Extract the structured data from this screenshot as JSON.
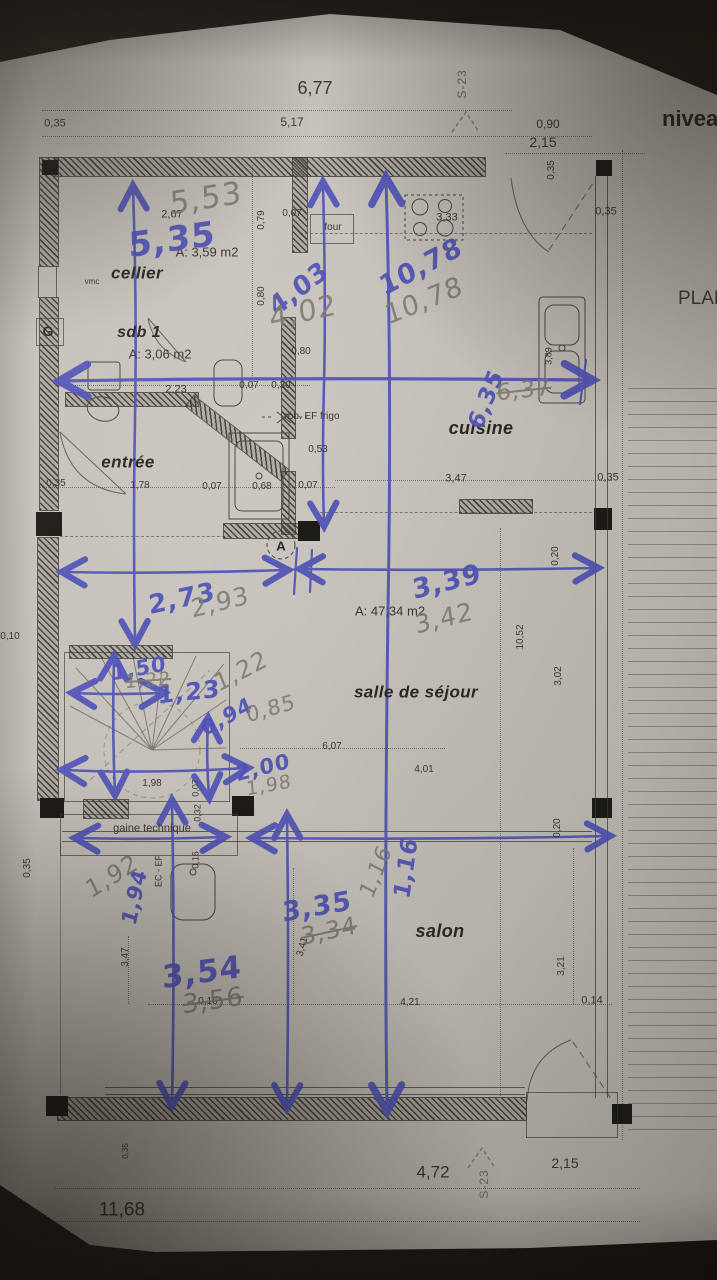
{
  "titles": {
    "level": "niveau",
    "plan": "PLAN"
  },
  "colors": {
    "ink_blue": "#5154b8",
    "pencil_gray": "#807c73",
    "print_dark": "#3b3934",
    "paper": "#c4c0b9"
  },
  "rooms": [
    {
      "t": "cellier",
      "x": 137,
      "y": 273,
      "s": 17
    },
    {
      "t": "sdb 1",
      "x": 139,
      "y": 333,
      "s": 16
    },
    {
      "t": "entrée",
      "x": 128,
      "y": 462,
      "s": 17
    },
    {
      "t": "cuisine",
      "x": 481,
      "y": 428,
      "s": 18
    },
    {
      "t": "salle de séjour",
      "x": 416,
      "y": 692,
      "s": 17
    },
    {
      "t": "salon",
      "x": 440,
      "y": 931,
      "s": 18
    }
  ],
  "area_labels": [
    {
      "t": "A: 3,59 m2",
      "x": 207,
      "y": 252,
      "s": 13
    },
    {
      "t": "A: 3,06 m2",
      "x": 160,
      "y": 354,
      "s": 13
    },
    {
      "t": "A: 47,34 m2",
      "x": 390,
      "y": 611,
      "s": 13
    }
  ],
  "small_labels": [
    {
      "t": "gaine technique",
      "x": 152,
      "y": 829,
      "s": 11
    },
    {
      "t": "four",
      "x": 333,
      "y": 228,
      "s": 10
    },
    {
      "t": "rob. EF frigo",
      "x": 312,
      "y": 417,
      "s": 10
    },
    {
      "t": "EC - EF",
      "x": 159,
      "y": 871,
      "s": 9,
      "r": -90
    },
    {
      "t": "vmc",
      "x": 92,
      "y": 282,
      "s": 8
    }
  ],
  "marker_labels": [
    {
      "t": "G",
      "x": 48,
      "y": 331,
      "s": 14
    },
    {
      "t": "A",
      "x": 281,
      "y": 546,
      "s": 13
    }
  ],
  "section_markers": [
    {
      "t": "S-23",
      "x": 462,
      "y": 84,
      "s": 12,
      "r": -90
    },
    {
      "t": "S-23",
      "x": 484,
      "y": 1184,
      "s": 12,
      "r": -90
    }
  ],
  "printed_dimensions": [
    {
      "t": "6,77",
      "x": 315,
      "y": 88,
      "s": 18
    },
    {
      "t": "0,35",
      "x": 55,
      "y": 124,
      "s": 11
    },
    {
      "t": "5,17",
      "x": 292,
      "y": 122,
      "s": 12
    },
    {
      "t": "0,90",
      "x": 548,
      "y": 124,
      "s": 12
    },
    {
      "t": "2,15",
      "x": 543,
      "y": 142,
      "s": 14
    },
    {
      "t": "2,67",
      "x": 172,
      "y": 215,
      "s": 11
    },
    {
      "t": "0,79",
      "x": 262,
      "y": 220,
      "s": 10,
      "r": -90
    },
    {
      "t": "0,07",
      "x": 292,
      "y": 214,
      "s": 10
    },
    {
      "t": "3,33",
      "x": 447,
      "y": 218,
      "s": 11
    },
    {
      "t": "0,35",
      "x": 552,
      "y": 170,
      "s": 10,
      "r": -90
    },
    {
      "t": "0,35",
      "x": 606,
      "y": 212,
      "s": 11
    },
    {
      "t": "0,80",
      "x": 262,
      "y": 296,
      "s": 10,
      "r": -90
    },
    {
      "t": "3,89",
      "x": 549,
      "y": 356,
      "s": 9,
      "r": -90
    },
    {
      "t": "2,23",
      "x": 176,
      "y": 390,
      "s": 11
    },
    {
      "t": "0,07",
      "x": 249,
      "y": 386,
      "s": 10
    },
    {
      "t": "0,30",
      "x": 281,
      "y": 386,
      "s": 10
    },
    {
      "t": "0,80",
      "x": 301,
      "y": 352,
      "s": 10
    },
    {
      "t": "0,53",
      "x": 318,
      "y": 450,
      "s": 10
    },
    {
      "t": "0,35",
      "x": 56,
      "y": 484,
      "s": 10
    },
    {
      "t": "1,78",
      "x": 140,
      "y": 486,
      "s": 10
    },
    {
      "t": "0,07",
      "x": 212,
      "y": 487,
      "s": 10
    },
    {
      "t": "0,68",
      "x": 262,
      "y": 487,
      "s": 10
    },
    {
      "t": "0,07",
      "x": 308,
      "y": 486,
      "s": 10
    },
    {
      "t": "3,47",
      "x": 456,
      "y": 479,
      "s": 11
    },
    {
      "t": "0,35",
      "x": 608,
      "y": 478,
      "s": 11
    },
    {
      "t": "0,20",
      "x": 556,
      "y": 556,
      "s": 10,
      "r": -90
    },
    {
      "t": "10,52",
      "x": 521,
      "y": 637,
      "s": 10,
      "r": -90
    },
    {
      "t": "3,02",
      "x": 559,
      "y": 676,
      "s": 10,
      "r": -90
    },
    {
      "t": "6,07",
      "x": 332,
      "y": 747,
      "s": 10
    },
    {
      "t": "4,01",
      "x": 424,
      "y": 770,
      "s": 10
    },
    {
      "t": "0,10",
      "x": 10,
      "y": 637,
      "s": 10
    },
    {
      "t": "1,98",
      "x": 152,
      "y": 784,
      "s": 10
    },
    {
      "t": "0,07",
      "x": 196,
      "y": 788,
      "s": 9,
      "r": -90
    },
    {
      "t": "0,32",
      "x": 198,
      "y": 813,
      "s": 9,
      "r": -90
    },
    {
      "t": "0,16",
      "x": 196,
      "y": 860,
      "s": 9,
      "r": -90
    },
    {
      "t": "0,35",
      "x": 28,
      "y": 868,
      "s": 10,
      "r": -90
    },
    {
      "t": "0,20",
      "x": 558,
      "y": 828,
      "s": 10,
      "r": -90
    },
    {
      "t": "3,47",
      "x": 126,
      "y": 957,
      "s": 10,
      "r": -90
    },
    {
      "t": "0,16",
      "x": 208,
      "y": 1002,
      "s": 10
    },
    {
      "t": "3,41",
      "x": 303,
      "y": 947,
      "s": 10,
      "r": -75
    },
    {
      "t": "4,21",
      "x": 410,
      "y": 1003,
      "s": 10
    },
    {
      "t": "3,21",
      "x": 562,
      "y": 966,
      "s": 10,
      "r": -90
    },
    {
      "t": "0,14",
      "x": 592,
      "y": 1001,
      "s": 11
    },
    {
      "t": "0,35",
      "x": 126,
      "y": 1151,
      "s": 8,
      "r": -90
    },
    {
      "t": "4,72",
      "x": 433,
      "y": 1172,
      "s": 17
    },
    {
      "t": "2,15",
      "x": 565,
      "y": 1163,
      "s": 14
    },
    {
      "t": "11,68",
      "x": 122,
      "y": 1210,
      "s": 19
    }
  ],
  "handwritten_blue": [
    {
      "t": "5,35",
      "x": 172,
      "y": 240,
      "s": 34,
      "r": -8
    },
    {
      "t": "4,03",
      "x": 299,
      "y": 289,
      "s": 26,
      "r": -38
    },
    {
      "t": "10,78",
      "x": 421,
      "y": 267,
      "s": 27,
      "r": -28
    },
    {
      "t": "6,35",
      "x": 487,
      "y": 400,
      "s": 23,
      "r": -68
    },
    {
      "t": "3,39",
      "x": 447,
      "y": 582,
      "s": 27,
      "r": -14
    },
    {
      "t": "2,73",
      "x": 182,
      "y": 599,
      "s": 26,
      "r": -12
    },
    {
      "t": "1,50",
      "x": 139,
      "y": 669,
      "s": 21,
      "r": -10
    },
    {
      "t": "1,23",
      "x": 189,
      "y": 692,
      "s": 24,
      "r": -6
    },
    {
      "t": "0,94",
      "x": 227,
      "y": 717,
      "s": 21,
      "r": -28
    },
    {
      "t": "2,00",
      "x": 263,
      "y": 768,
      "s": 21,
      "r": -14
    },
    {
      "t": "1,94",
      "x": 135,
      "y": 897,
      "s": 21,
      "r": -78
    },
    {
      "t": "3,35",
      "x": 317,
      "y": 907,
      "s": 27,
      "r": -10
    },
    {
      "t": "1,16",
      "x": 407,
      "y": 868,
      "s": 23,
      "r": -82
    },
    {
      "t": "3,54",
      "x": 202,
      "y": 973,
      "s": 31,
      "r": -8
    }
  ],
  "handwritten_pencil": [
    {
      "t": "5,53",
      "x": 206,
      "y": 199,
      "s": 31,
      "r": -9
    },
    {
      "t": "4,02",
      "x": 303,
      "y": 312,
      "s": 29,
      "r": -12
    },
    {
      "t": "10,78",
      "x": 424,
      "y": 301,
      "s": 27,
      "r": -22
    },
    {
      "t": "6,37",
      "x": 524,
      "y": 391,
      "s": 23,
      "r": -6,
      "k": 1
    },
    {
      "t": "3,42",
      "x": 444,
      "y": 618,
      "s": 25,
      "r": -14
    },
    {
      "t": "2,93",
      "x": 220,
      "y": 602,
      "s": 25,
      "r": -14
    },
    {
      "t": "1,22",
      "x": 148,
      "y": 681,
      "s": 19,
      "r": -4,
      "k": 1
    },
    {
      "t": "1,22",
      "x": 241,
      "y": 671,
      "s": 24,
      "r": -28
    },
    {
      "t": "0,85",
      "x": 271,
      "y": 709,
      "s": 21,
      "r": -16
    },
    {
      "t": "1,98",
      "x": 269,
      "y": 786,
      "s": 19,
      "r": -10
    },
    {
      "t": "1,92",
      "x": 112,
      "y": 876,
      "s": 24,
      "r": -32
    },
    {
      "t": "3,34",
      "x": 329,
      "y": 931,
      "s": 24,
      "r": -12,
      "k": 1
    },
    {
      "t": "1,16",
      "x": 377,
      "y": 872,
      "s": 22,
      "r": -68
    },
    {
      "t": "3,56",
      "x": 213,
      "y": 1001,
      "s": 26,
      "r": -8,
      "k": 1
    }
  ]
}
